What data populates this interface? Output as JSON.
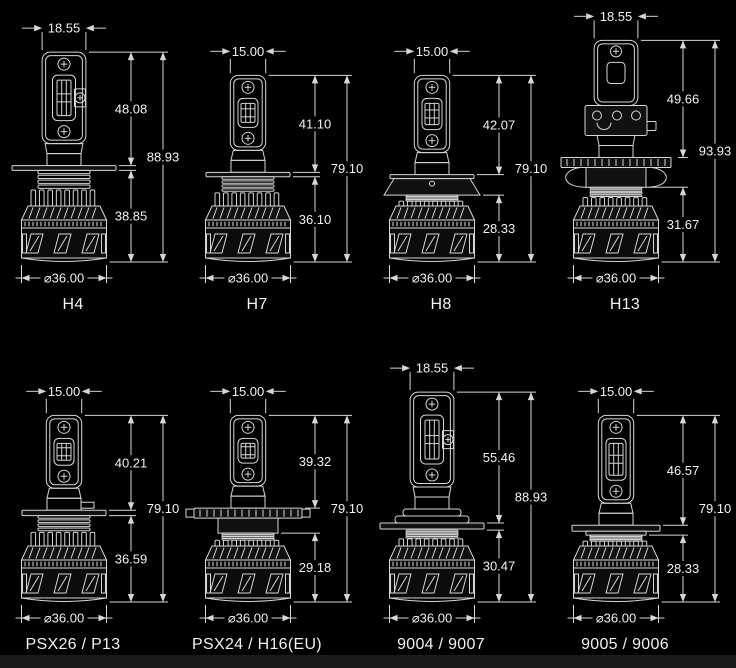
{
  "page": {
    "background": "#000000",
    "line_color": "#d6d6d6",
    "text_color": "#f1f1f1",
    "footer_bar_color": "#1a1a1a"
  },
  "diagram": {
    "description": "LED headlight bulb dimension drawings, millimetres",
    "diameter_prefix": "⌀",
    "bulbs": [
      {
        "label": "H4",
        "top_width": "18.55",
        "upper_height": "48.08",
        "total_height": "88.93",
        "lower_height": "38.85",
        "diameter": "36.00"
      },
      {
        "label": "H7",
        "top_width": "15.00",
        "upper_height": "41.10",
        "total_height": "79.10",
        "lower_height": "36.10",
        "diameter": "36.00"
      },
      {
        "label": "H8",
        "top_width": "15.00",
        "upper_height": "42.07",
        "total_height": "79.10",
        "lower_height": "28.33",
        "diameter": "36.00"
      },
      {
        "label": "H13",
        "top_width": "18.55",
        "upper_height": "49.66",
        "total_height": "93.93",
        "lower_height": "31.67",
        "diameter": "36.00"
      },
      {
        "label": "PSX26 / P13",
        "top_width": "15.00",
        "upper_height": "40.21",
        "total_height": "79.10",
        "lower_height": "36.59",
        "diameter": "36.00"
      },
      {
        "label": "PSX24 / H16(EU)",
        "top_width": "15.00",
        "upper_height": "39.32",
        "total_height": "79.10",
        "lower_height": "29.18",
        "diameter": "36.00"
      },
      {
        "label": "9004 / 9007",
        "top_width": "18.55",
        "upper_height": "55.46",
        "total_height": "88.93",
        "lower_height": "30.47",
        "diameter": "36.00"
      },
      {
        "label": "9005 / 9006",
        "top_width": "15.00",
        "upper_height": "46.57",
        "total_height": "79.10",
        "lower_height": "28.33",
        "diameter": "36.00"
      }
    ]
  }
}
